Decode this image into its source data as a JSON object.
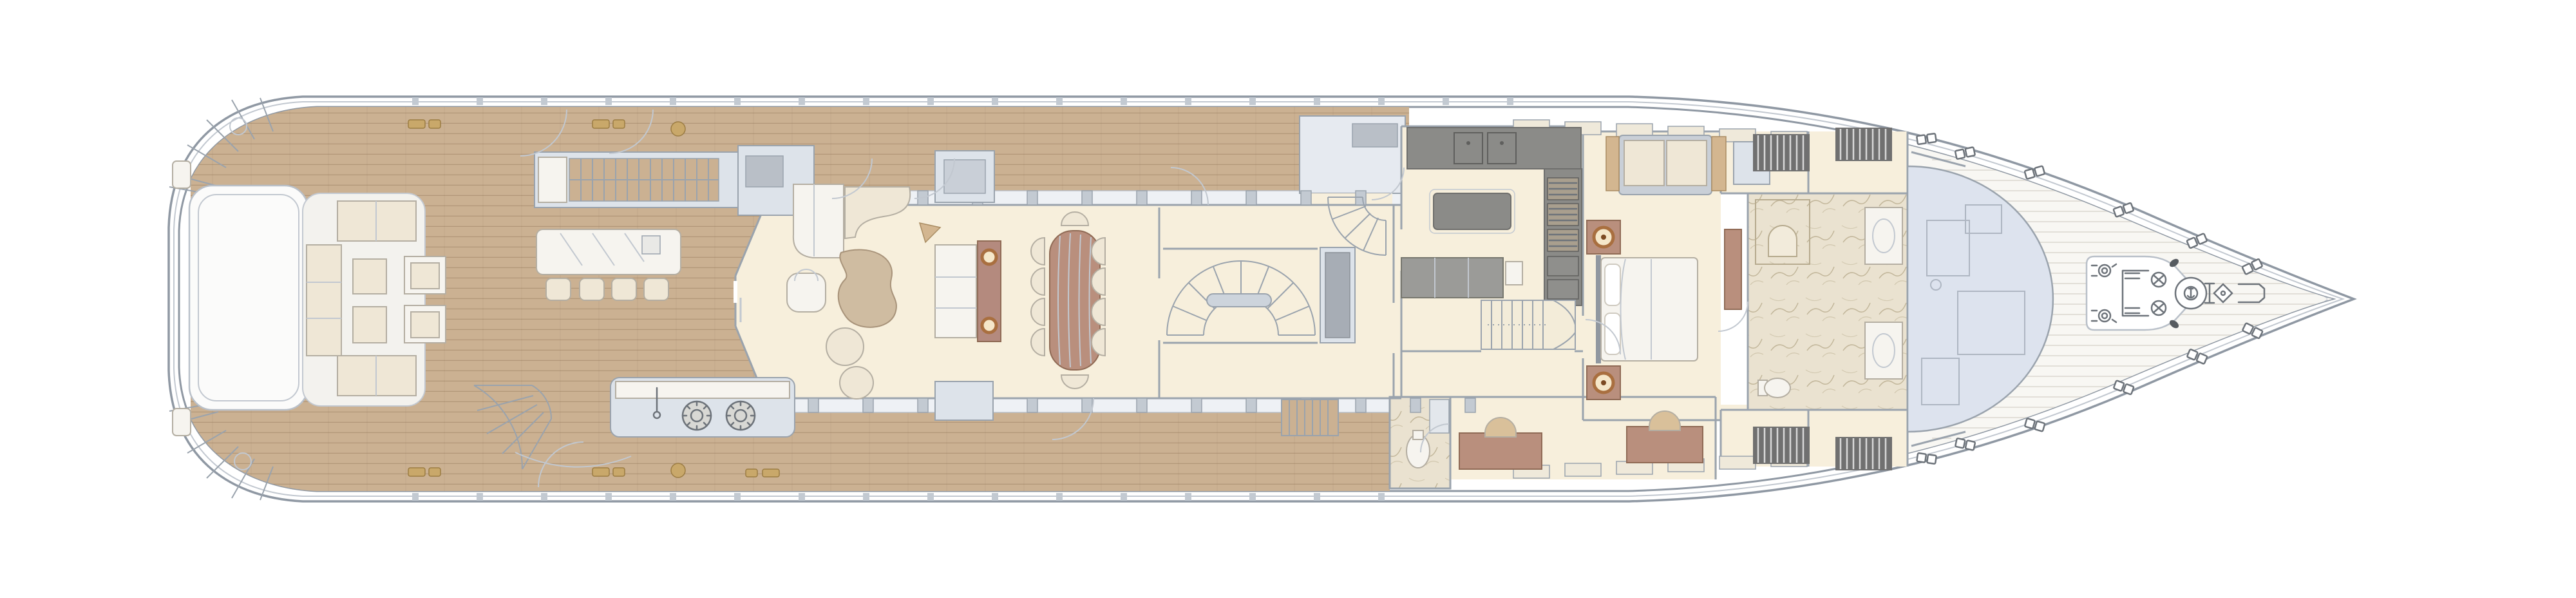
{
  "colors": {
    "background": "#ffffff",
    "hull_outline": "#8f98a3",
    "hull_white": "#ffffff",
    "bulwark_band": "#eef1f5",
    "teak_deck": "#cbb192",
    "walkway_teak": "#c8ae8e",
    "interior_floor": "#f7efdc",
    "wall_fill": "#dde3ea",
    "wall_line": "#9aa3ad",
    "dark_counter": "#8b8b88",
    "white_furniture": "#f6f4ef",
    "cream_cushion": "#efe7d6",
    "furniture_shadow": "#b4aea2",
    "wood_brown": "#b98f7d",
    "wood_light": "#d3b690",
    "bronze_lamp": "#a96f3f",
    "marble_floor": "#eae2d0",
    "marble_vein": "#cdc3ab",
    "glass_dome": "#dde3ee",
    "slat_dark": "#707070",
    "sketch_line": "#6d737a",
    "fitting_tan": "#c9a86a"
  },
  "plan": {
    "type": "yacht-deck-floor-plan",
    "orientation": "bow-right",
    "regions": [
      "stern-platform",
      "aft-deck-lounge",
      "aft-bar",
      "outdoor-galley-grill",
      "upper-deck-staircase",
      "side-walkway-port",
      "side-walkway-starboard",
      "main-salon",
      "dining-area",
      "midship-lobby",
      "spiral-staircase",
      "elevator",
      "galley",
      "pantry",
      "crew-staircase",
      "day-head",
      "master-stateroom",
      "master-bathroom",
      "wardrobes",
      "wheelhouse-skylight",
      "foredeck",
      "bow-working-deck"
    ]
  }
}
